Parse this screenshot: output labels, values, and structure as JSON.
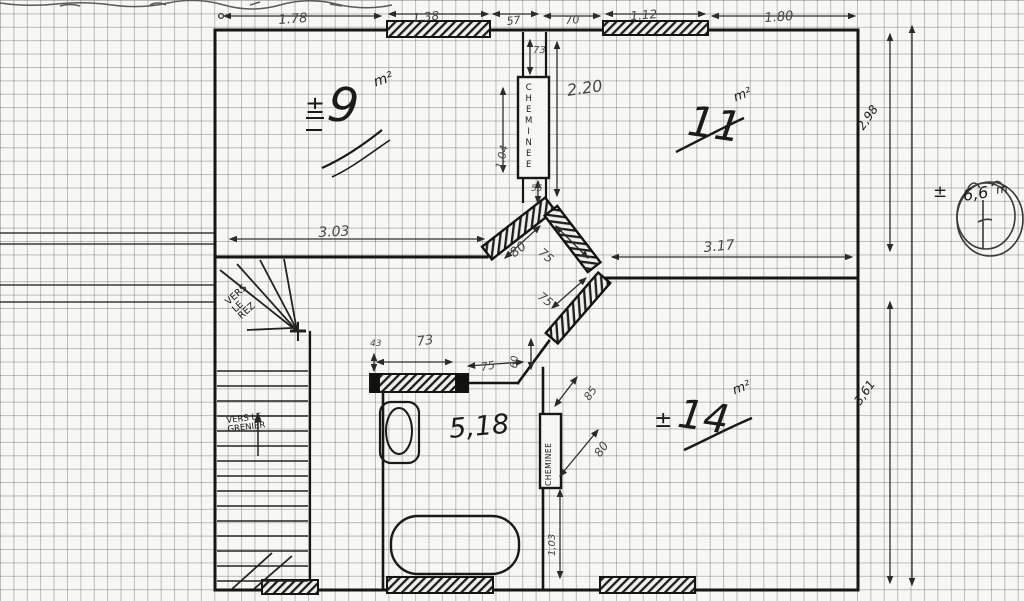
{
  "rooms": {
    "room9": {
      "sign": "±",
      "value": "9",
      "unit": "m²"
    },
    "room11": {
      "value": "11",
      "unit": "m²"
    },
    "room14": {
      "sign": "±",
      "value": "14",
      "unit": "m²"
    },
    "bath": {
      "value": "5,18"
    }
  },
  "labels": {
    "chimney_top": "CHEMINEE",
    "chimney_bottom": "CHEMINEE",
    "to_ground": "VERS\nLE\nREZ",
    "to_attic": "VERS LE\nGRENIER",
    "total": {
      "sign": "±",
      "value": "6,6",
      "unit": "m"
    }
  },
  "dims": {
    "top": {
      "a": "1.78",
      "b": "1.38",
      "c": "57",
      "d": "70",
      "e": "1.12",
      "f": "1.80"
    },
    "right": {
      "upper": "2,98",
      "lower": "3,61"
    },
    "mid": {
      "left": "3.03",
      "right": "3.17"
    },
    "chimney": {
      "h": "73",
      "len": "2.20",
      "side": "1.04",
      "w": "55"
    },
    "diag": {
      "a": "80",
      "b": "75",
      "c": "75"
    },
    "bath": {
      "a": "43",
      "b": "73",
      "c": "75",
      "d": "60",
      "e": "85",
      "f": "80",
      "g": "1,03"
    }
  },
  "colors": {
    "ink": "#1b1b1b",
    "pencil": "#474747",
    "grid": "#8c8c90"
  }
}
